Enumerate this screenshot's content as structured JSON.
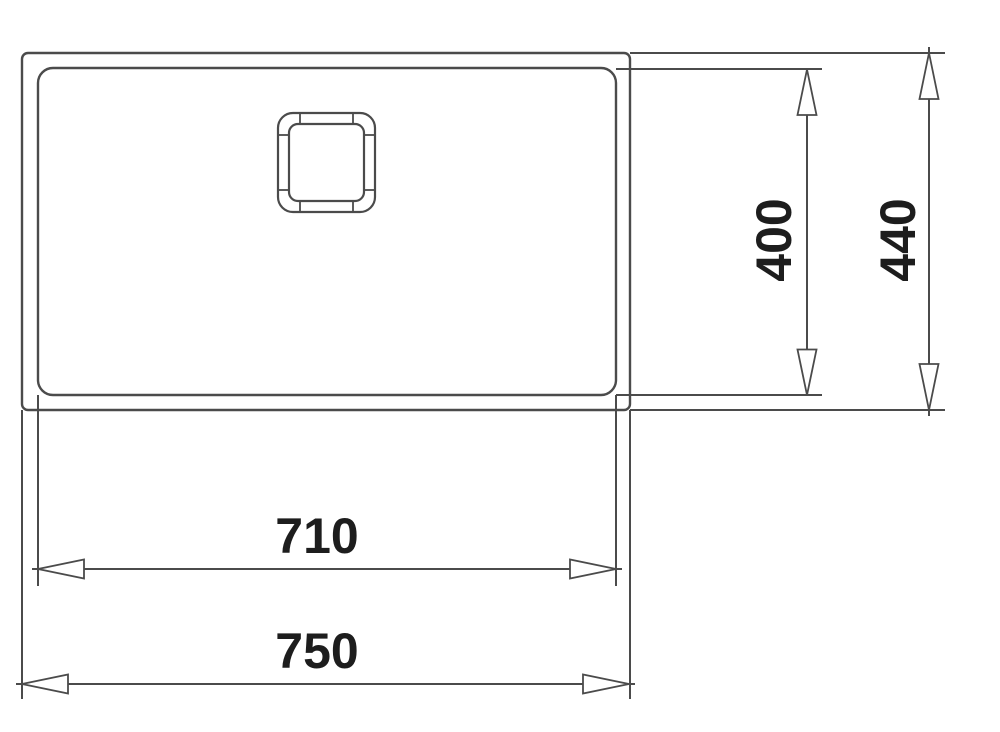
{
  "diagram": {
    "type": "technical-dimension-drawing",
    "subject": "sink-top-view",
    "dimensions": {
      "inner_width": "710",
      "outer_width": "750",
      "inner_depth": "400",
      "outer_depth": "440"
    },
    "colors": {
      "line": "#4b4b4b",
      "text": "#1d1d1d",
      "background": "#ffffff",
      "arrow_fill": "#ffffff"
    }
  }
}
